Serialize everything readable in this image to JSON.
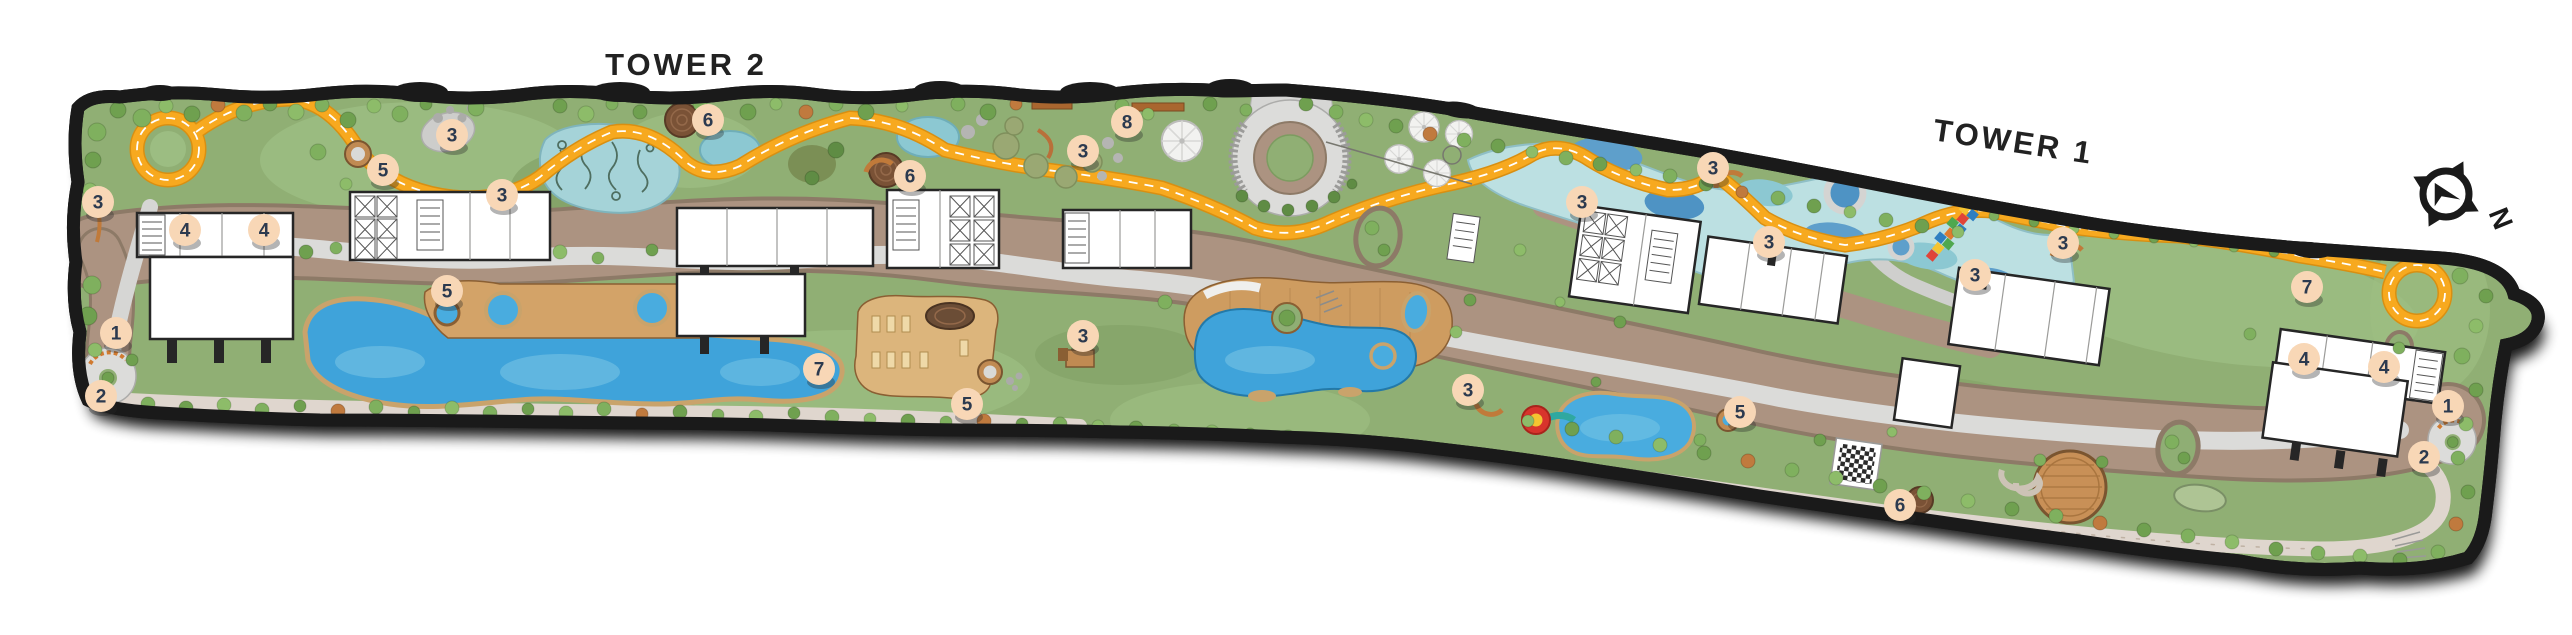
{
  "palette": {
    "track_orange": "#F7A91F",
    "track_edge": "#D88F12",
    "marker_fill": "#F8D7B6",
    "marker_text": "#2C3A4F",
    "pool_blue": "#3FA3DA",
    "stream_teal": "#BCE0E2",
    "grass_green": "#90AF74",
    "path_brown": "#AC9381",
    "path_gray": "#DBDBD9",
    "deck_wood": "#CE9C60",
    "boundary_black": "#1A1A1A",
    "building_white": "#FFFFFF"
  },
  "map": {
    "tower2_label": "TOWER 2",
    "tower1_label": "TOWER 1",
    "compass": {
      "north_label": "N"
    },
    "markers": [
      {
        "label": "3",
        "x": 98,
        "y": 202
      },
      {
        "label": "4",
        "x": 185,
        "y": 230
      },
      {
        "label": "4",
        "x": 264,
        "y": 230
      },
      {
        "label": "1",
        "x": 116,
        "y": 333
      },
      {
        "label": "2",
        "x": 101,
        "y": 396
      },
      {
        "label": "3",
        "x": 452,
        "y": 135
      },
      {
        "label": "5",
        "x": 383,
        "y": 170
      },
      {
        "label": "3",
        "x": 502,
        "y": 195
      },
      {
        "label": "5",
        "x": 447,
        "y": 291
      },
      {
        "label": "6",
        "x": 708,
        "y": 120
      },
      {
        "label": "6",
        "x": 910,
        "y": 176
      },
      {
        "label": "3",
        "x": 1083,
        "y": 151
      },
      {
        "label": "8",
        "x": 1127,
        "y": 122
      },
      {
        "label": "3",
        "x": 1083,
        "y": 336
      },
      {
        "label": "7",
        "x": 819,
        "y": 369
      },
      {
        "label": "5",
        "x": 967,
        "y": 404
      },
      {
        "label": "3",
        "x": 1468,
        "y": 390
      },
      {
        "label": "3",
        "x": 1582,
        "y": 202
      },
      {
        "label": "3",
        "x": 1713,
        "y": 168
      },
      {
        "label": "3",
        "x": 1769,
        "y": 242
      },
      {
        "label": "3",
        "x": 1975,
        "y": 275
      },
      {
        "label": "3",
        "x": 2063,
        "y": 243
      },
      {
        "label": "5",
        "x": 1740,
        "y": 412
      },
      {
        "label": "6",
        "x": 1900,
        "y": 505
      },
      {
        "label": "7",
        "x": 2307,
        "y": 287
      },
      {
        "label": "4",
        "x": 2304,
        "y": 359
      },
      {
        "label": "4",
        "x": 2384,
        "y": 367
      },
      {
        "label": "1",
        "x": 2448,
        "y": 406
      },
      {
        "label": "2",
        "x": 2424,
        "y": 457
      }
    ]
  }
}
